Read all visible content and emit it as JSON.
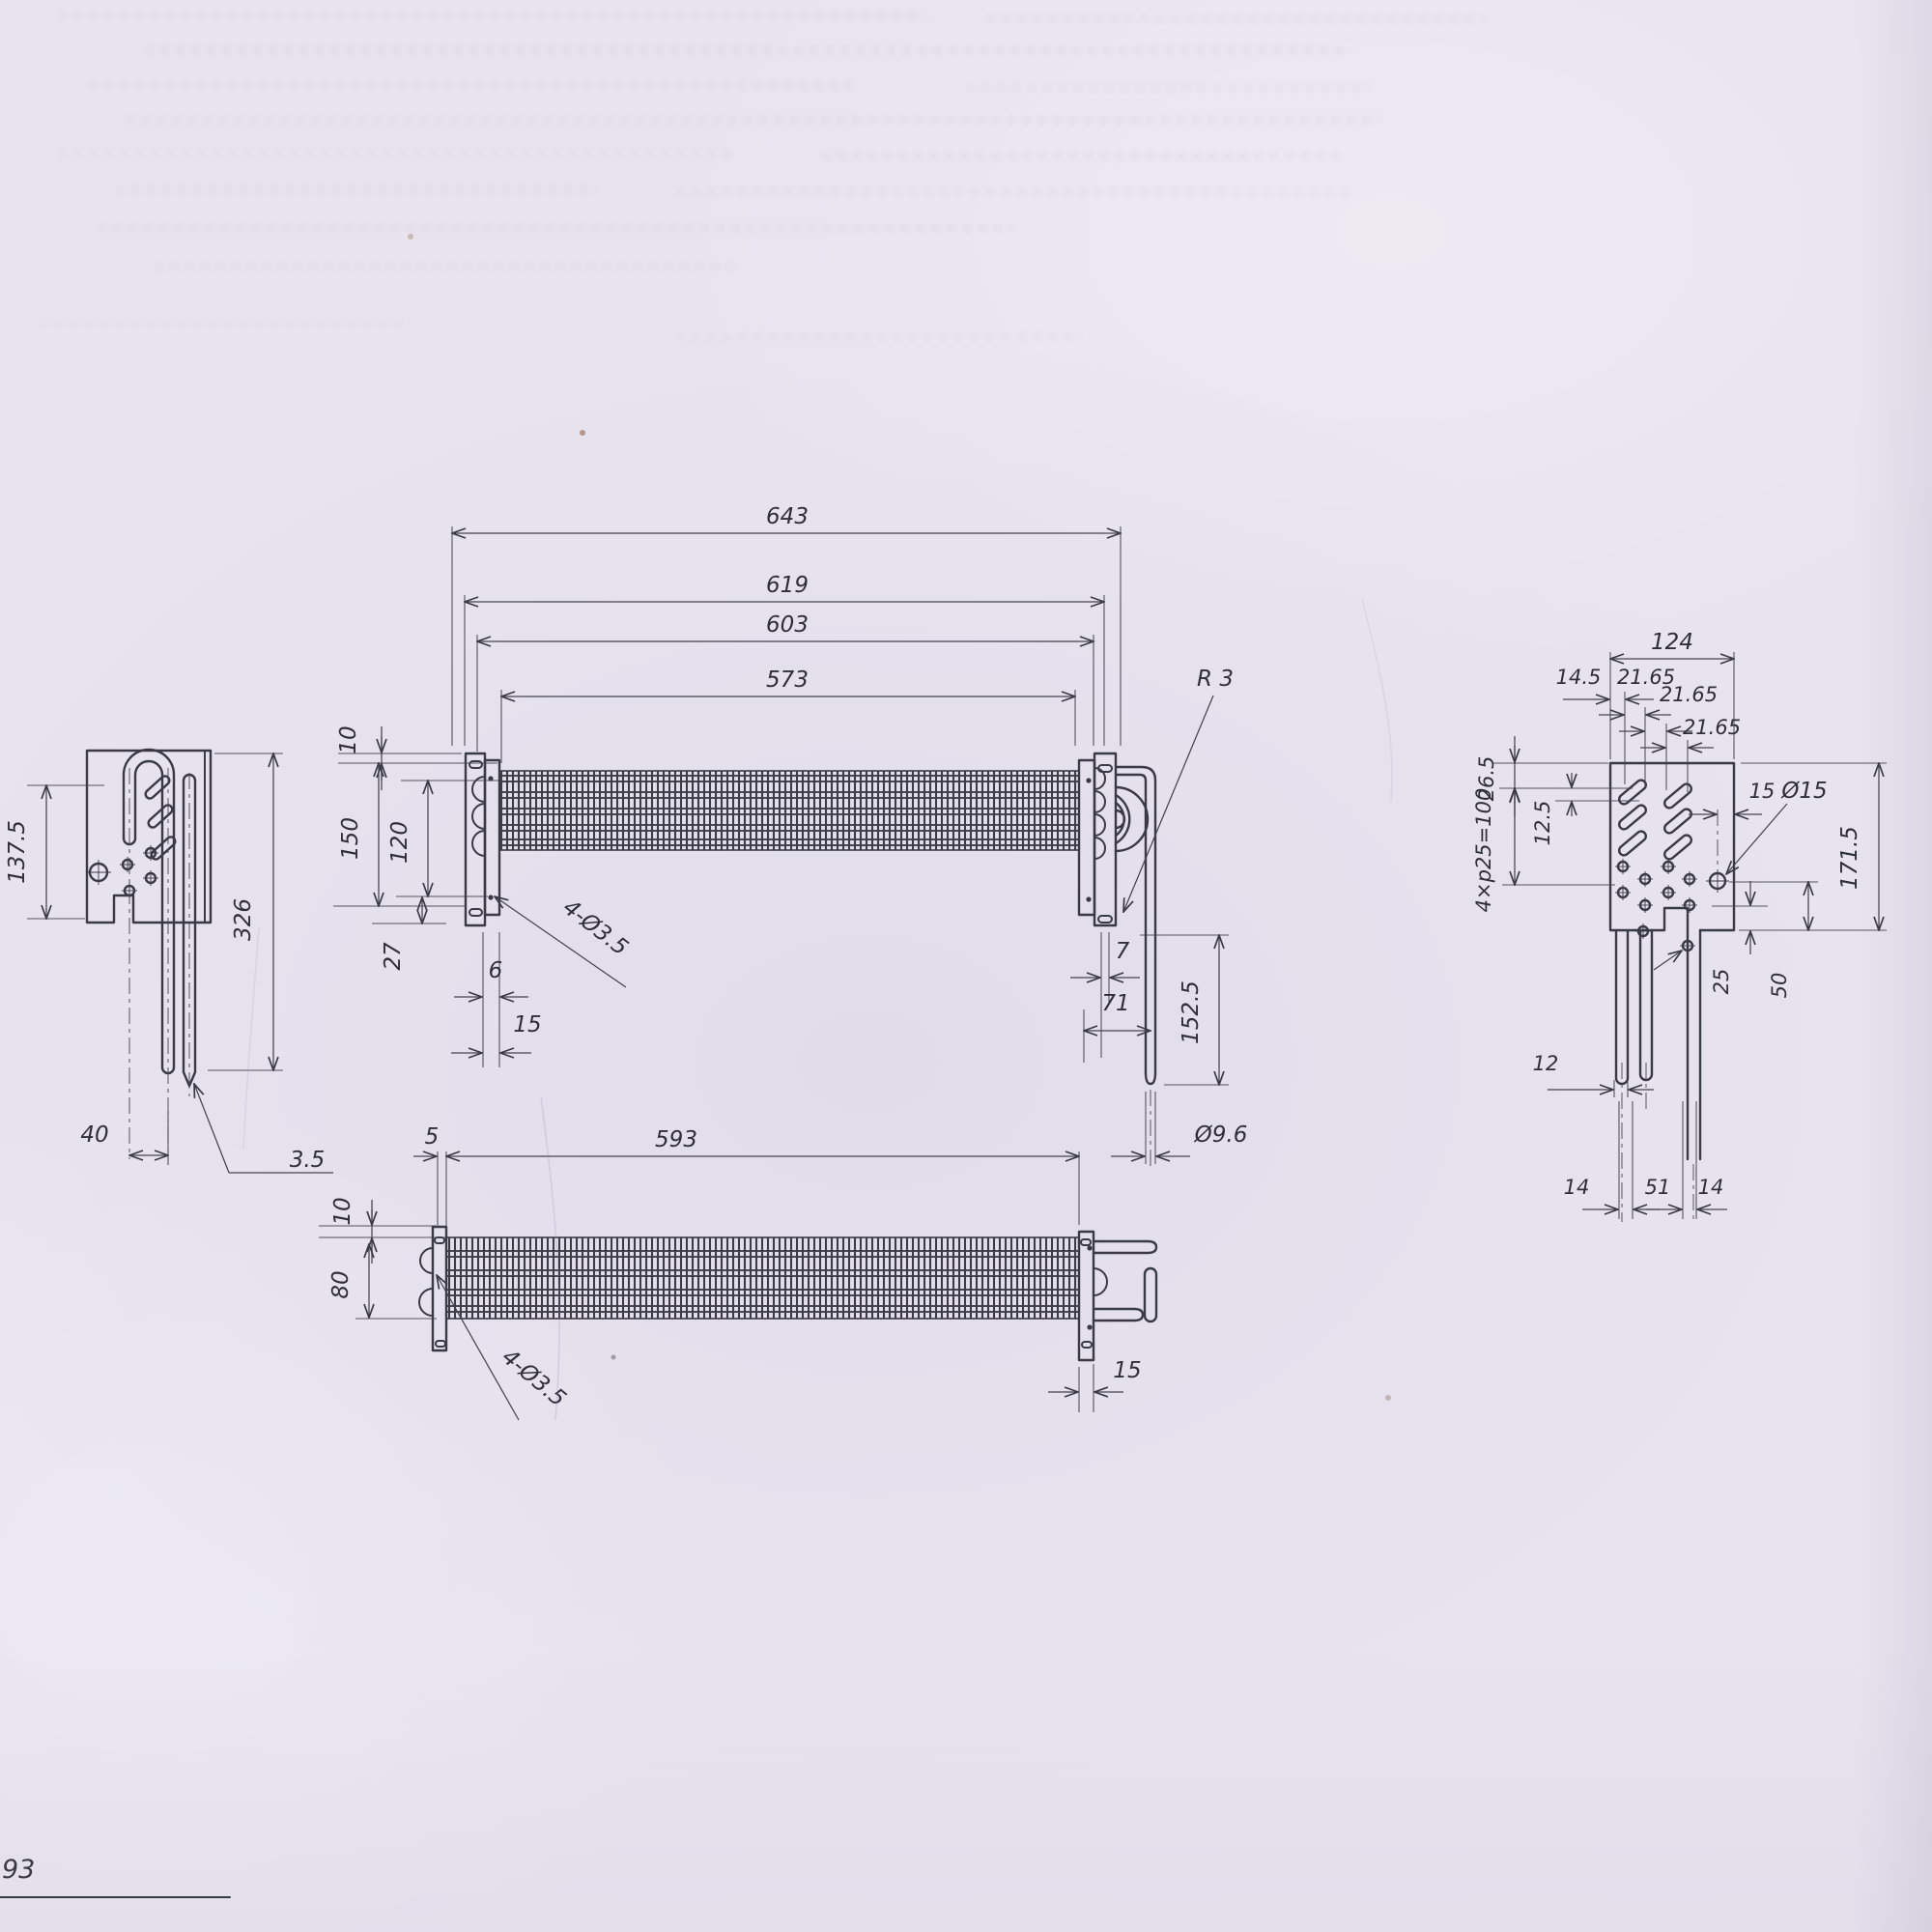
{
  "page": {
    "corner_fragment": "93"
  },
  "front_view": {
    "len_overall": "643",
    "len_619": "619",
    "len_603": "603",
    "len_573": "573",
    "off_10": "10",
    "h_150": "150",
    "h_120": "120",
    "v_27": "27",
    "w_6": "6",
    "w_15": "15",
    "holes": "4-Ø3.5",
    "radius": "R 3",
    "w_7": "7",
    "w_71": "71",
    "h_1525": "152.5",
    "dia_tube": "Ø9.6"
  },
  "plan_view": {
    "off_5": "5",
    "len_593": "593",
    "off_10": "10",
    "h_80": "80",
    "holes": "4-Ø3.5",
    "w_15": "15"
  },
  "side_view": {
    "h_1375": "137.5",
    "h_326": "326",
    "w_40": "40",
    "tip": "3.5"
  },
  "end_view": {
    "w_124": "124",
    "w_145": "14.5",
    "p_a": "21.65",
    "p_b": "21.65",
    "p_c": "21.65",
    "v_265": "26.5",
    "v_125": "12.5",
    "pitch": "4×p25=100",
    "w_15": "15",
    "dia_15": "Ø15",
    "h_1715": "171.5",
    "v_25": "25",
    "v_50": "50",
    "dia_12": "12",
    "b_14a": "14",
    "b_51": "51",
    "b_14b": "14"
  }
}
